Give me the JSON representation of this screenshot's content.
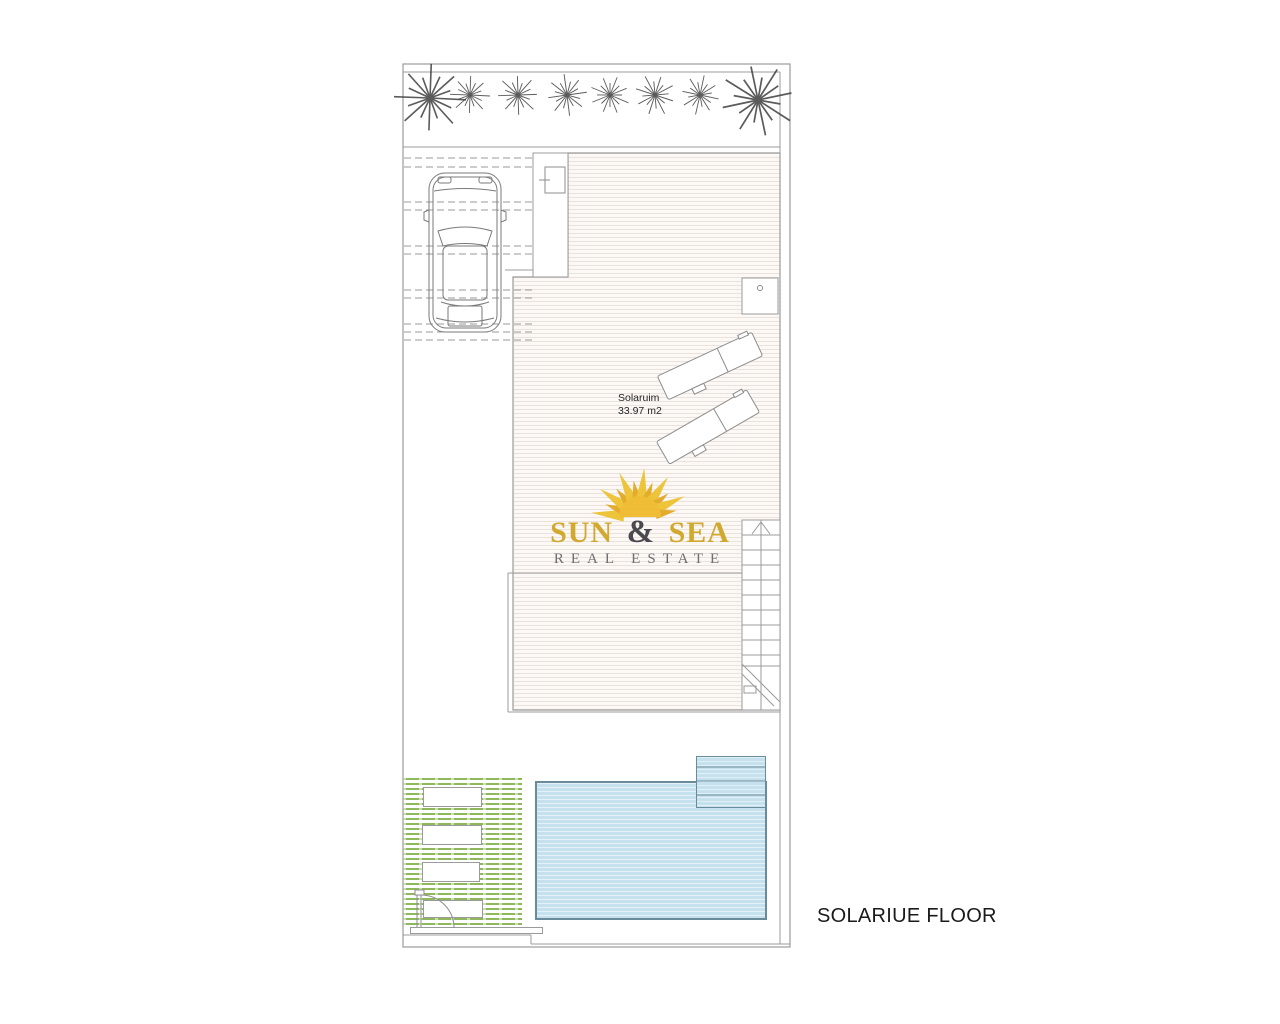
{
  "page": {
    "background_color": "#ffffff",
    "floor_title": "SOLARIUE FLOOR"
  },
  "room": {
    "name": "Solaruim",
    "area": "33.97 m2"
  },
  "logo": {
    "word1": "SUN",
    "ampersand": "&",
    "word2": "SEA",
    "tagline": "REAL ESTATE",
    "sun_color": "#eebc2e",
    "gold_text_color": "#d2a92f",
    "ampersand_color": "#4a4a4e",
    "tagline_color": "#6f6f6f"
  },
  "colors": {
    "outline_gray": "#9b9b9b",
    "linework_dark": "#3f3f3f",
    "deck_stripe": "#ebe2dc",
    "pool_fill": "#c5e1ed",
    "pool_border": "#6a8b99",
    "garden_green": "#8fb75c"
  },
  "elements": {
    "plants_row": {
      "count": 8,
      "icon": "palm-plant-icon"
    },
    "vehicle": "car-top-view-icon",
    "sun_loungers": {
      "count": 2,
      "icon": "sun-lounger-icon"
    },
    "staircase": "staircase-up",
    "pool": "swimming-pool",
    "pool_steps": "pool-steps",
    "garden": "green-lawn-area",
    "door": "swing-door",
    "equipment_box": "outdoor-fixture-box",
    "sun_logo": "sun-rays-icon"
  }
}
